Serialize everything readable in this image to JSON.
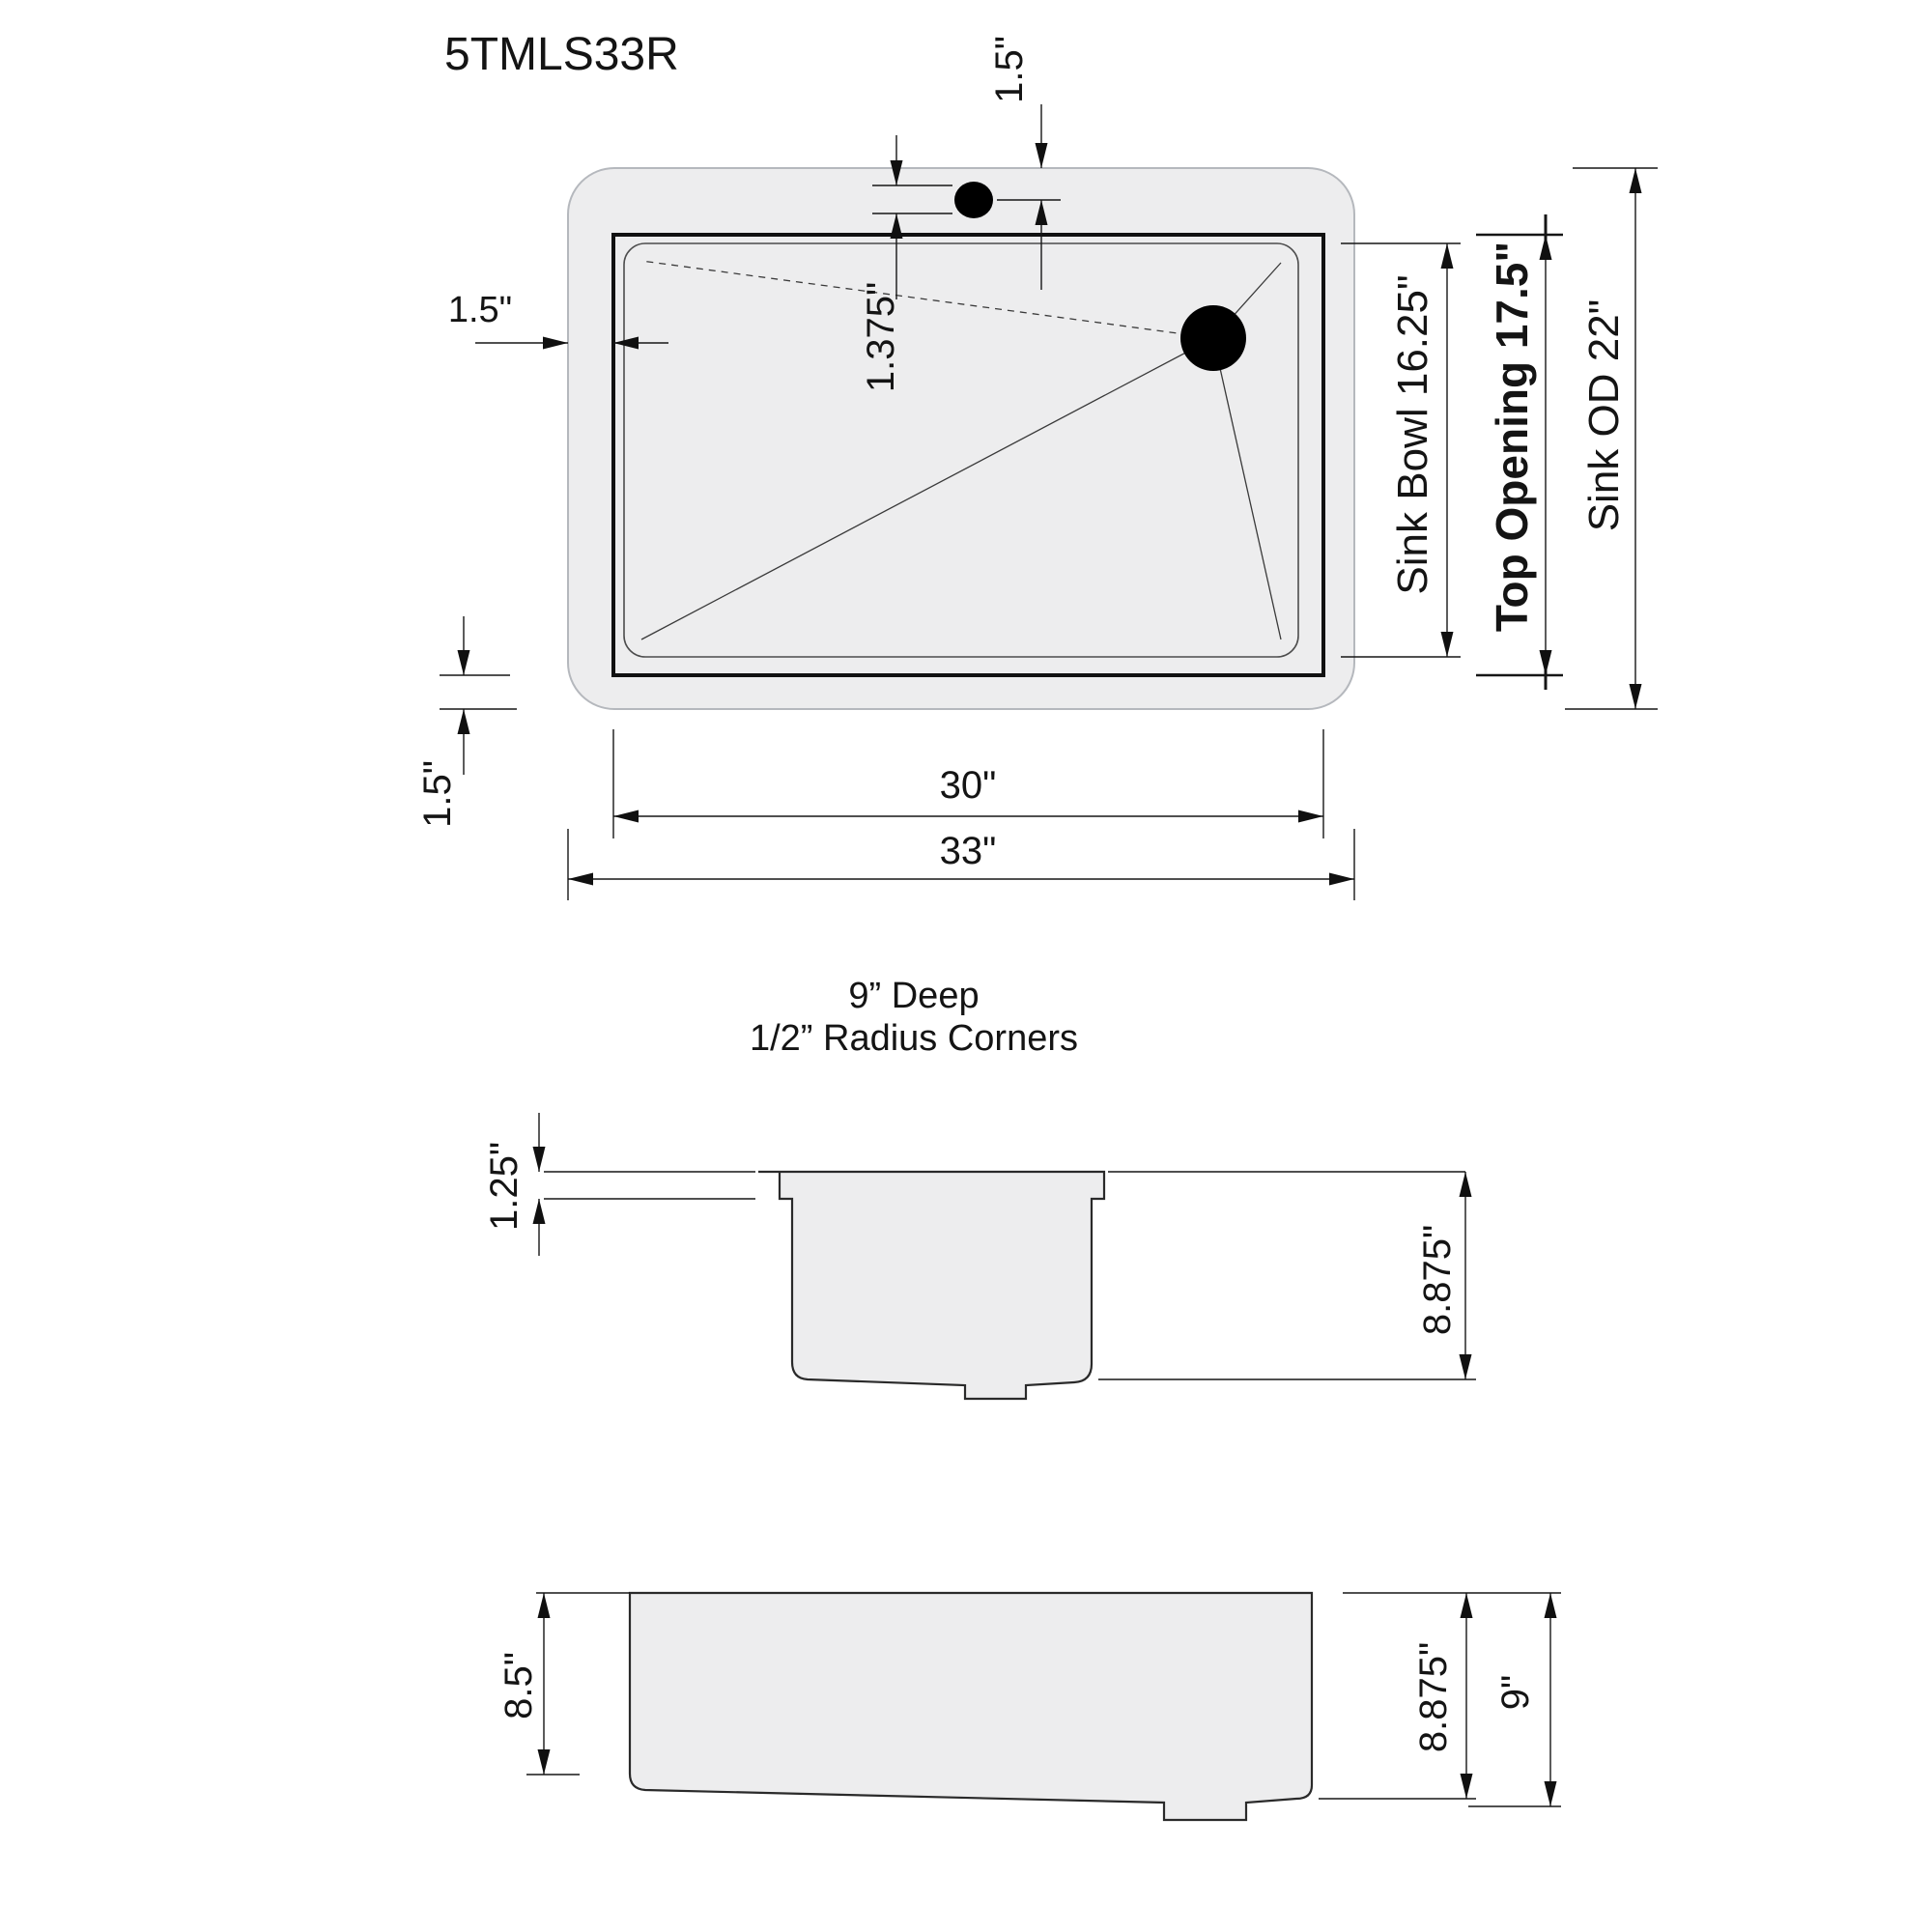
{
  "title": "5TMLS33R",
  "top_view": {
    "dims": {
      "faucet_offset": "1.5\"",
      "faucet_hole": "1.375\"",
      "rim_left": "1.5\"",
      "rim_bottom": "1.5\"",
      "opening_width": "30\"",
      "overall_width": "33\"",
      "sink_bowl": "Sink Bowl 16.25\"",
      "top_opening": "Top Opening 17.5\"",
      "sink_od": "Sink OD 22\""
    }
  },
  "notes": {
    "depth": "9” Deep",
    "radius_corners": "1/2”  Radius Corners"
  },
  "end_view": {
    "dims": {
      "flange_height": "1.25\"",
      "bowl_depth": "8.875\""
    }
  },
  "side_view": {
    "dims": {
      "shallow_depth": "8.5\"",
      "bowl_depth": "8.875\"",
      "overall_depth": "9\""
    }
  },
  "colors": {
    "line": "#161616",
    "sink_fill": "#ededee",
    "outer_stroke": "#b5b8bd",
    "hole_fill": "#000000"
  }
}
